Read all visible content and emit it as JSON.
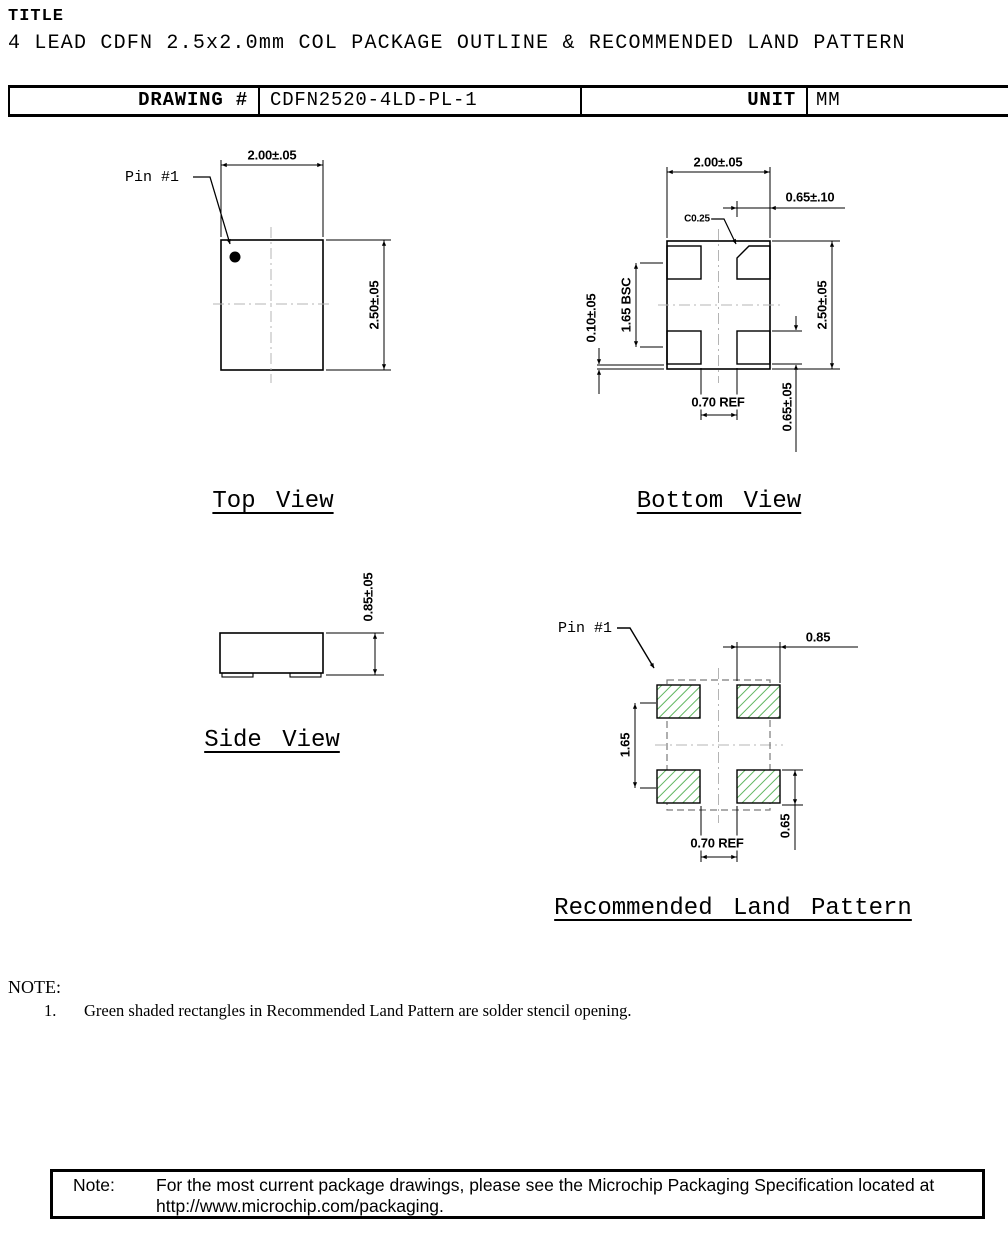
{
  "header": {
    "title_label": "TITLE",
    "document_title": "4 LEAD CDFN 2.5x2.0mm COL PACKAGE OUTLINE & RECOMMENDED LAND PATTERN",
    "table": {
      "drawing_label": "DRAWING #",
      "drawing_number": "CDFN2520-4LD-PL-1",
      "unit_label": "UNIT",
      "unit_value": "MM"
    }
  },
  "top_view": {
    "label": "Top View",
    "pin1_label": "Pin #1",
    "dim_body_width": "2.00±.05",
    "dim_body_height": "2.50±.05"
  },
  "bottom_view": {
    "label": "Bottom View",
    "dim_body_width": "2.00±.05",
    "dim_pad_width": "0.65±.10",
    "chamfer_callout": "C0.25",
    "dim_pad_pitch": "1.65 BSC",
    "dim_pad_pullback": "0.10±.05",
    "dim_body_height": "2.50±.05",
    "dim_pad_gap": "0.70 REF",
    "dim_pad_length": "0.65±.05"
  },
  "side_view": {
    "label": "Side View",
    "dim_body_thickness": "0.85±.05"
  },
  "land_pattern": {
    "label": "Recommended Land Pattern",
    "pin1_label": "Pin #1",
    "dim_pad_width": "0.85",
    "dim_pad_pitch": "1.65",
    "dim_pad_gap": "0.70 REF",
    "dim_pad_height": "0.65"
  },
  "notes": {
    "heading": "NOTE:",
    "items": [
      {
        "number": "1.",
        "text": "Green shaded rectangles in Recommended Land Pattern are solder stencil opening."
      }
    ]
  },
  "footer_note": {
    "label": "Note:",
    "line1": "For the most current package drawings, please see the Microchip Packaging Specification located at",
    "line2": "http://www.microchip.com/packaging."
  },
  "colors": {
    "line": "#000000",
    "hatch_green": "#4fae4f",
    "centerline": "#b4b4b4",
    "dashed_outline": "#7a7a7a"
  }
}
